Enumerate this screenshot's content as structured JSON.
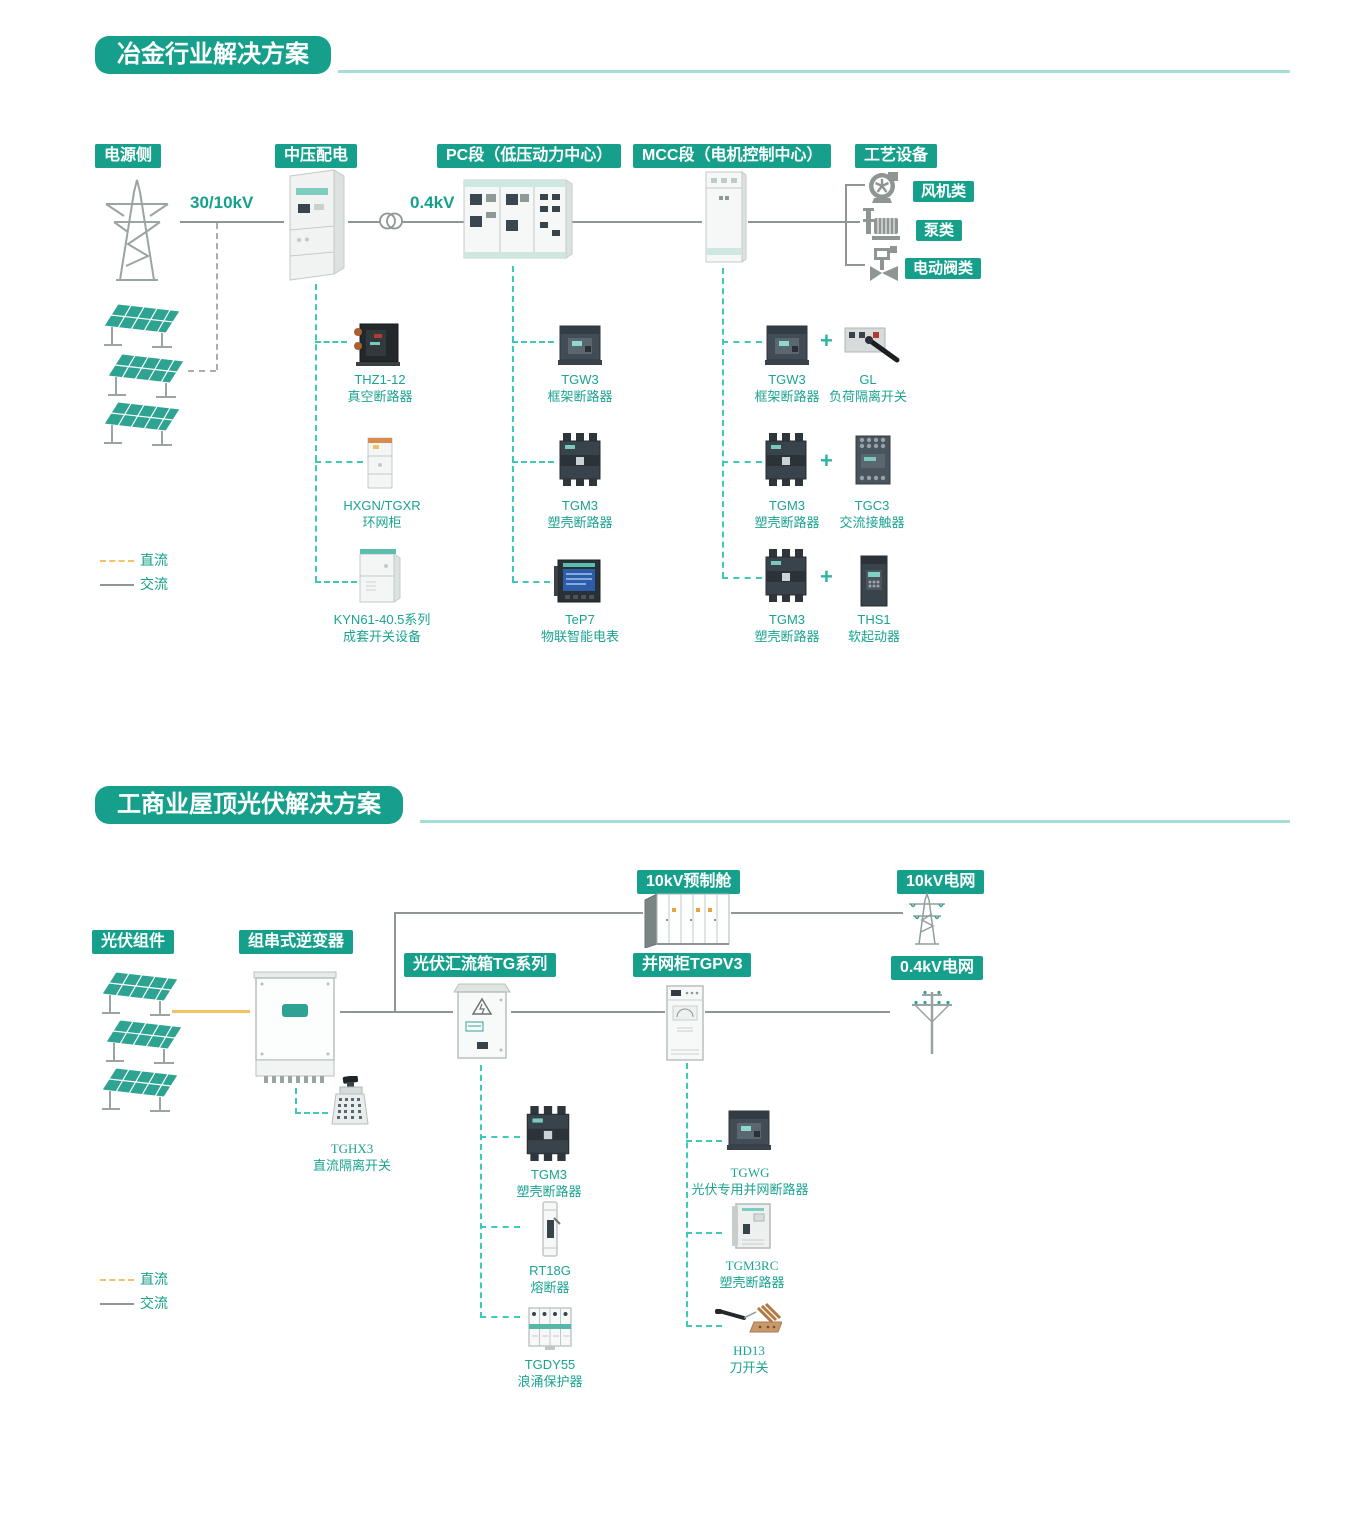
{
  "s1": {
    "title": "冶金行业解决方案",
    "col_power": "电源侧",
    "col_mv": "中压配电",
    "col_pc": "PC段（低压动力中心）",
    "col_mcc": "MCC段（电机控制中心）",
    "col_process": "工艺设备",
    "hv_label": "30/10kV",
    "lv_label": "0.4kV",
    "loads": [
      "风机类",
      "泵类",
      "电动阀类"
    ],
    "legend_dc": "直流",
    "legend_ac": "交流",
    "mv_devices": [
      {
        "model": "THZ1-12",
        "name": "真空断路器"
      },
      {
        "model": "HXGN/TGXR",
        "name": "环网柜"
      },
      {
        "model": "KYN61-40.5系列",
        "name": "成套开关设备"
      }
    ],
    "pc_devices": [
      {
        "model": "TGW3",
        "name": "框架断路器"
      },
      {
        "model": "TGM3",
        "name": "塑壳断路器"
      },
      {
        "model": "TeP7",
        "name": "物联智能电表"
      }
    ],
    "mcc_pairs": [
      {
        "left_model": "TGW3",
        "left_name": "框架断路器",
        "plus": "+",
        "right_model": "GL",
        "right_name": "负荷隔离开关"
      },
      {
        "left_model": "TGM3",
        "left_name": "塑壳断路器",
        "plus": "+",
        "right_model": "TGC3",
        "right_name": "交流接触器"
      },
      {
        "left_model": "TGM3",
        "left_name": "塑壳断路器",
        "plus": "+",
        "right_model": "THS1",
        "right_name": "软起动器"
      }
    ]
  },
  "s2": {
    "title": "工商业屋顶光伏解决方案",
    "label_cabin": "10kV预制舱",
    "label_grid10": "10kV电网",
    "label_pv": "光伏组件",
    "label_inverter": "组串式逆变器",
    "label_combiner": "光伏汇流箱TG系列",
    "label_gridcab": "并网柜TGPV3",
    "label_grid04": "0.4kV电网",
    "legend_dc": "直流",
    "legend_ac": "交流",
    "inverter_device": {
      "model": "TGHX3",
      "name": "直流隔离开关"
    },
    "combiner_devices": [
      {
        "model": "TGM3",
        "name": "塑壳断路器"
      },
      {
        "model": "RT18G",
        "name": "熔断器"
      },
      {
        "model": "TGDY55",
        "name": "浪涌保护器"
      }
    ],
    "gridcab_devices": [
      {
        "model": "TGWG",
        "name": "光伏专用并网断路器"
      },
      {
        "model": "TGM3RC",
        "name": "塑壳断路器"
      },
      {
        "model": "HD13",
        "name": "刀开关"
      }
    ]
  }
}
